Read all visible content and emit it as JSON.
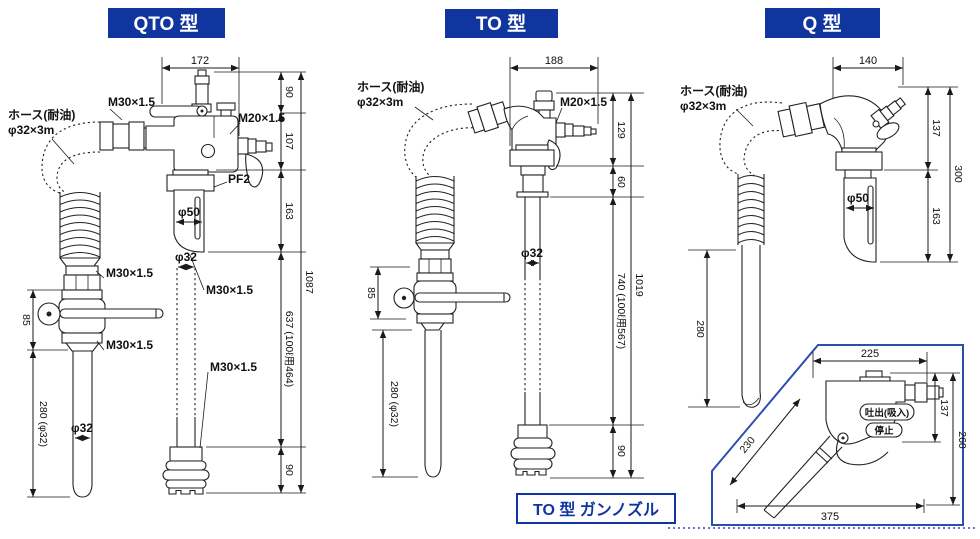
{
  "colors": {
    "accent": "#10359f",
    "box_blue": "#2b4fae",
    "line": "#222222",
    "background": "#ffffff"
  },
  "qto": {
    "title": "QTO 型",
    "hose_label_line1": "ホース(耐油)",
    "hose_label_line2": "φ32×3m",
    "m30_hose": "M30×1.5",
    "m20": "M20×1.5",
    "pf2": "PF2",
    "phi50": "φ50",
    "m30_mid": "M30×1.5",
    "phi32_center": "φ32",
    "m30_left_top": "M30×1.5",
    "m30_left_bottom": "M30×1.5",
    "m30_bottom": "M30×1.5",
    "phi32_left": "φ32",
    "dim_top_width": "172",
    "dim_left_85": "85",
    "dim_left_280": "280 (φ32)",
    "seg_90a": "90",
    "seg_107": "107",
    "seg_163": "163",
    "seg_637": "637 (100ℓ用464)",
    "seg_90b": "90",
    "dim_total": "1087"
  },
  "to": {
    "title": "TO 型",
    "hose_label_line1": "ホース(耐油)",
    "hose_label_line2": "φ32×3m",
    "m20": "M20×1.5",
    "phi32_center": "φ32",
    "dim_top_width": "188",
    "dim_left_85": "85",
    "dim_left_280": "280 (φ32)",
    "seg_129": "129",
    "seg_60": "60",
    "seg_740": "740 (100ℓ用567)",
    "seg_90": "90",
    "dim_total": "1019"
  },
  "q": {
    "title": "Q 型",
    "hose_label_line1": "ホース(耐油)",
    "hose_label_line2": "φ32×3m",
    "phi50": "φ50",
    "dim_top_width": "140",
    "dim_left_280": "280",
    "seg_137": "137",
    "seg_163": "163",
    "dim_total": "300"
  },
  "gun": {
    "title": "TO 型 ガンノズル",
    "dim_top_width": "225",
    "dim_spout": "230",
    "dim_body_height": "137",
    "dim_total_height": "260",
    "dim_total_width": "375",
    "label_discharge": "吐出(吸入)",
    "label_stop": "停止"
  }
}
